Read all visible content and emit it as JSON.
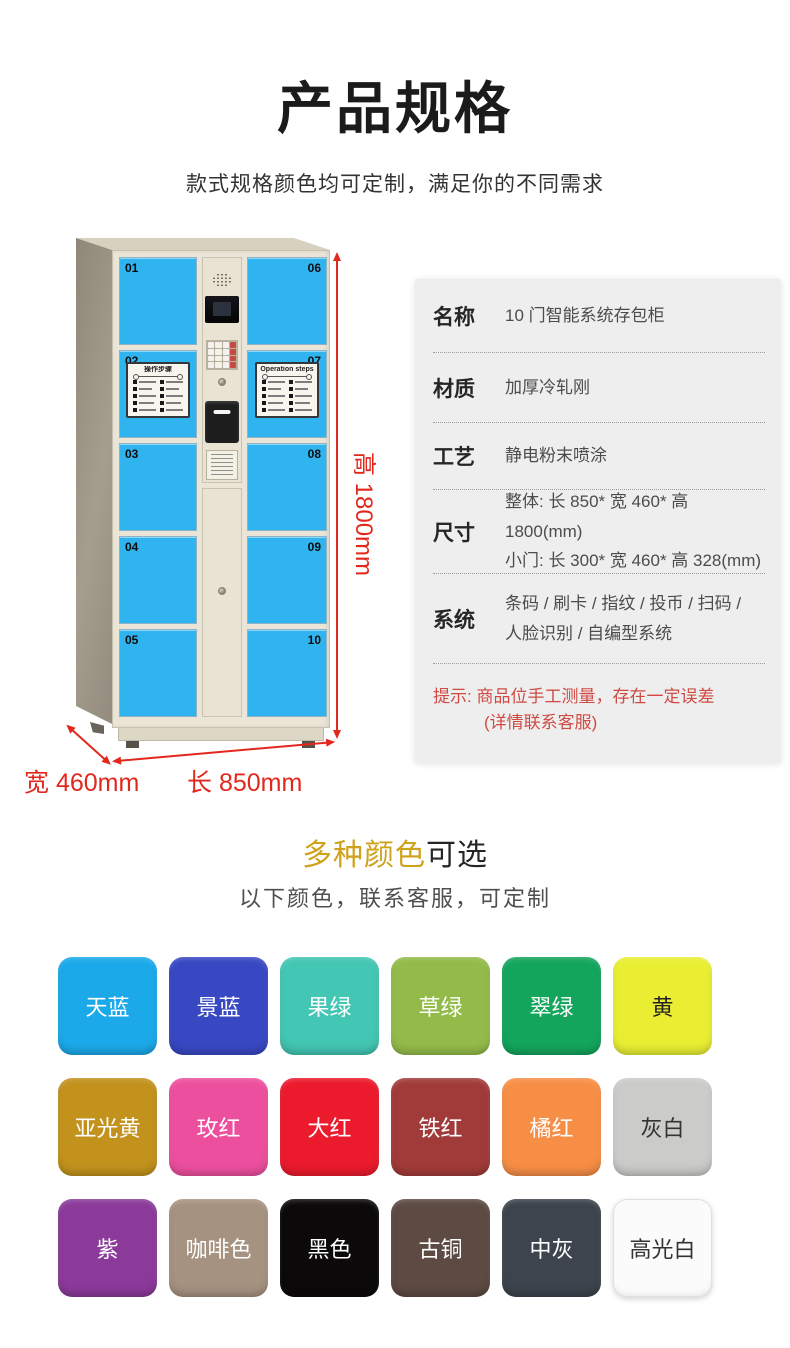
{
  "header": {
    "title": "产品规格",
    "subtitle": "款式规格颜色均可定制，满足你的不同需求"
  },
  "locker": {
    "left_door_numbers": [
      "01",
      "02",
      "03",
      "04",
      "05"
    ],
    "right_door_numbers": [
      "06",
      "07",
      "08",
      "09",
      "10"
    ],
    "sticker_titles": [
      "操作步骤",
      "Operation steps"
    ],
    "dims": {
      "height": "高 1800mm",
      "width": "宽 460mm",
      "length": "长 850mm"
    }
  },
  "specs": {
    "rows": [
      {
        "label": "名称",
        "lines": [
          "10 门智能系统存包柜"
        ]
      },
      {
        "label": "材质",
        "lines": [
          "加厚冷轧刚"
        ]
      },
      {
        "label": "工艺",
        "lines": [
          "静电粉末喷涂"
        ]
      },
      {
        "label": "尺寸",
        "lines": [
          "整体: 长 850* 宽 460* 高 1800(mm)",
          "小门: 长 300* 宽 460* 高 328(mm)"
        ]
      },
      {
        "label": "系统",
        "lines": [
          "条码 / 刷卡 / 指纹 / 投币 / 扫码 /",
          "人脸识别 / 自编型系统"
        ]
      }
    ],
    "note": {
      "line1": "提示: 商品位手工测量，存在一定误差",
      "line2": "(详情联系客服)"
    }
  },
  "colors_section": {
    "heading_highlight": "多种颜色",
    "heading_rest": "可选",
    "subtitle": "以下颜色，联系客服，可定制",
    "swatches": [
      {
        "label": "天蓝",
        "color": "#1ba9e9",
        "text": "#ffffff"
      },
      {
        "label": "景蓝",
        "color": "#3848c3",
        "text": "#ffffff"
      },
      {
        "label": "果绿",
        "color": "#43c6b3",
        "text": "#ffffff"
      },
      {
        "label": "草绿",
        "color": "#93bb49",
        "text": "#ffffff"
      },
      {
        "label": "翠绿",
        "color": "#14a55c",
        "text": "#ffffff"
      },
      {
        "label": "黄",
        "color": "#e9ee33",
        "text": "#222222"
      },
      {
        "label": "亚光黄",
        "color": "#c2921d",
        "text": "#ffffff"
      },
      {
        "label": "玫红",
        "color": "#ec4f9e",
        "text": "#ffffff"
      },
      {
        "label": "大红",
        "color": "#ec1a2d",
        "text": "#ffffff"
      },
      {
        "label": "铁红",
        "color": "#a13b39",
        "text": "#ffffff"
      },
      {
        "label": "橘红",
        "color": "#f78e46",
        "text": "#ffffff"
      },
      {
        "label": "灰白",
        "color": "#cbcbc9",
        "text": "#333333"
      },
      {
        "label": "紫",
        "color": "#8b3a9a",
        "text": "#ffffff"
      },
      {
        "label": "咖啡色",
        "color": "#a69281",
        "text": "#ffffff"
      },
      {
        "label": "黑色",
        "color": "#0b090a",
        "text": "#ffffff"
      },
      {
        "label": "古铜",
        "color": "#5c4a43",
        "text": "#ffffff"
      },
      {
        "label": "中灰",
        "color": "#3d444d",
        "text": "#ffffff"
      },
      {
        "label": "高光白",
        "color": "#fbfbfb",
        "text": "#333333"
      }
    ]
  },
  "theme": {
    "dimension_red": "#e2271d",
    "note_red": "#cf4a43",
    "gold": "#cfa21c",
    "door_blue": "#2fb4f0"
  }
}
